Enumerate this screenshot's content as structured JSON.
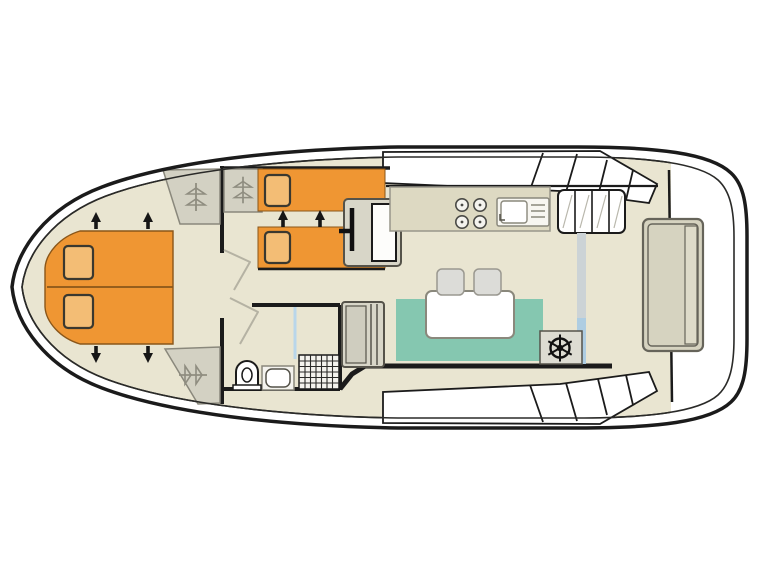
{
  "meta": {
    "label": "Houseboat deck plan, top view, bow at left",
    "type": "boat-floor-plan"
  },
  "colors": {
    "hull": "#1b1b1b",
    "floor": "#e9e5d1",
    "bed": "#ef9633",
    "bed_edge": "#8a5619",
    "pillow": "#f3bd75",
    "seating": "#85c7b0",
    "wardrobe": "#d3d1c3",
    "hanger": "#8f8d80",
    "counter": "#ddd9c2",
    "table": "#ffffff",
    "stool": "#dcdcd8",
    "helm": "#dddcd2",
    "stern_bench": "#d6d3c0",
    "steps": "#ffffff",
    "window": "#ffffff",
    "shower_screen": "#b9d6ea",
    "door_track": "#ccd3d6",
    "door_track_glass": "#aecde2",
    "door_panel": "#d8d6c8"
  },
  "features": {
    "bow_cabin": "double-bed-with-two-pillows-and-extension-arrows",
    "wardrobes": "three-wardrobes-with-hanger-icons",
    "mid_cabin": "two-single-beds-with-pillows-and-arrows",
    "bathroom": "toilet-washbasin-shower",
    "galley": "four-burner-stove-and-sink-with-drainer",
    "salon": "u-shaped-bench-table-two-stools",
    "helm": "steering-wheel-station",
    "aft": "stern-bench-and-deck-steps"
  }
}
